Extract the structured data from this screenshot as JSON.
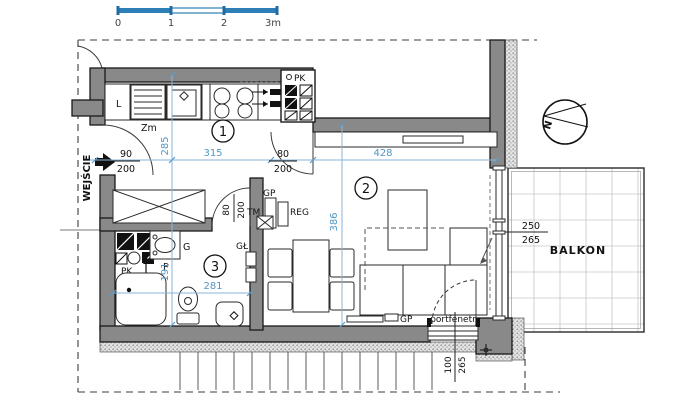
{
  "scale_bar": {
    "labels": [
      "0",
      "1",
      "2",
      "3m"
    ]
  },
  "compass": {
    "label": "N"
  },
  "entry": {
    "label": "WEJŚCIE"
  },
  "rooms": {
    "r1": "1",
    "r2": "2",
    "r3": "3"
  },
  "balcony": {
    "label": "BALKON",
    "dim_num": "250",
    "dim_den": "265"
  },
  "balcony_door": {
    "label": "portfenetr",
    "dim_num": "100",
    "dim_den": "265"
  },
  "kitchen": {
    "fridge": "L",
    "sink": "Zm",
    "shaft": "PK"
  },
  "bathroom": {
    "shaft": "PK",
    "washer": "P",
    "basin": "G",
    "door_num": "80",
    "door_den": "200"
  },
  "labels": {
    "gp_top": "GP",
    "gp_bottom": "GP",
    "tm": "TM",
    "reg": "REG",
    "gl": "GŁ"
  },
  "dims": {
    "entrance_num": "90",
    "entrance_den": "200",
    "pass_num": "80",
    "pass_den": "200",
    "hall_width": "315",
    "living_width": "428",
    "hall_depth": "285",
    "living_depth": "386",
    "bath_width": "281",
    "bath_depth": "191"
  },
  "colors": {
    "accent_blue": "#2e7fb8",
    "dim_blue": "#4f97c4",
    "wall_gray": "#898989"
  }
}
